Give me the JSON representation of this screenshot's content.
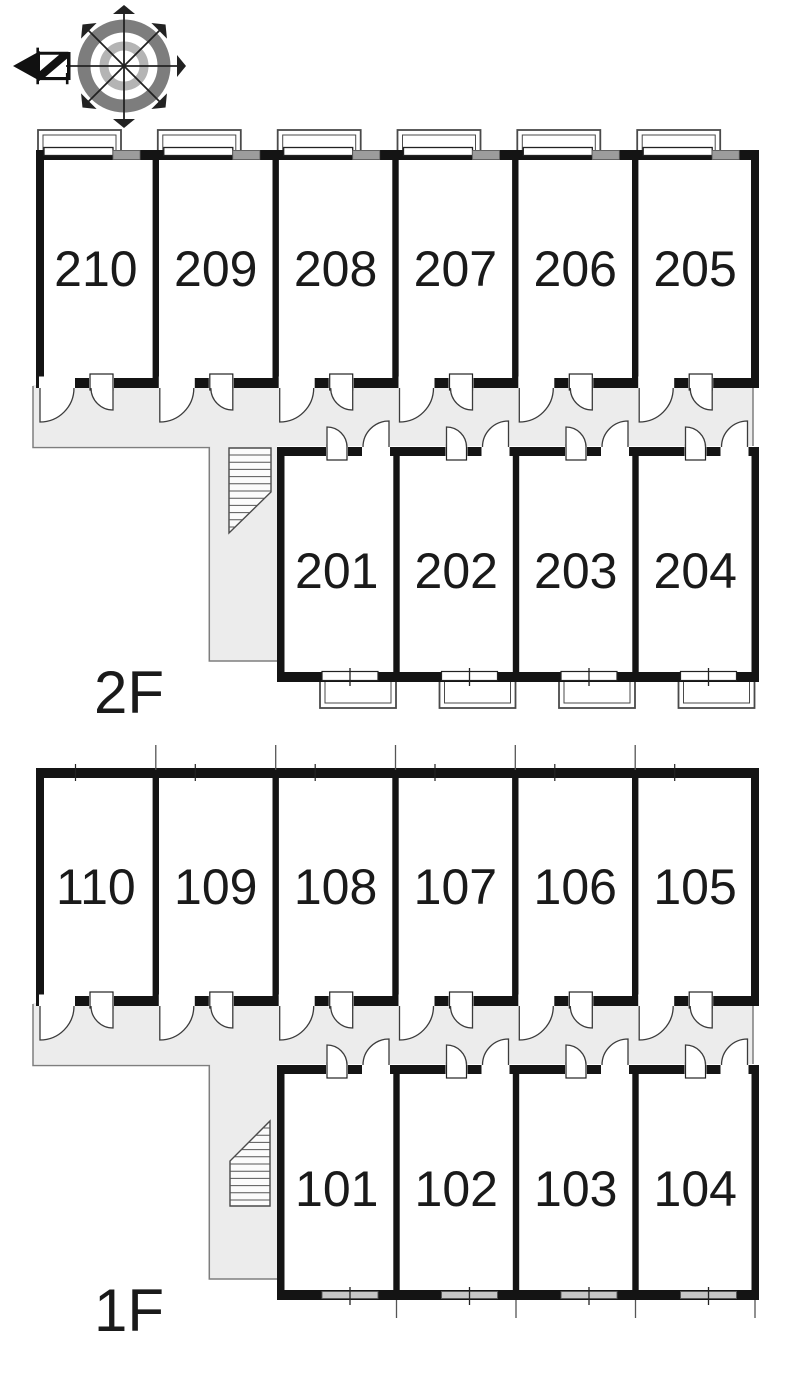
{
  "title": "apartment-floor-plan",
  "compass": {
    "north_label": "N"
  },
  "floors": [
    {
      "id": "2F",
      "label": "2F",
      "upper_rooms": [
        "210",
        "209",
        "208",
        "207",
        "206",
        "205"
      ],
      "lower_rooms": [
        "201",
        "202",
        "203",
        "204"
      ],
      "has_balconies": true,
      "has_stairs": true
    },
    {
      "id": "1F",
      "label": "1F",
      "upper_rooms": [
        "110",
        "109",
        "108",
        "107",
        "106",
        "105"
      ],
      "lower_rooms": [
        "101",
        "102",
        "103",
        "104"
      ],
      "has_balconies": false,
      "has_stairs": true
    }
  ],
  "colors": {
    "wall": "#141414",
    "corridor_fill": "#ececec",
    "corridor_line": "#7e7e7e",
    "door_stroke": "#3c3c3c",
    "window_gray_2f": "#9c9c9c",
    "window_gray_1f": "#c6c6c6",
    "balcony_line": "#4a4a4a",
    "stair_line": "#555555",
    "compass_ring_outer": "#7d7d7d",
    "compass_ring_inner": "#b4b4b4",
    "text": "#1a1a1a",
    "background": "#ffffff"
  }
}
